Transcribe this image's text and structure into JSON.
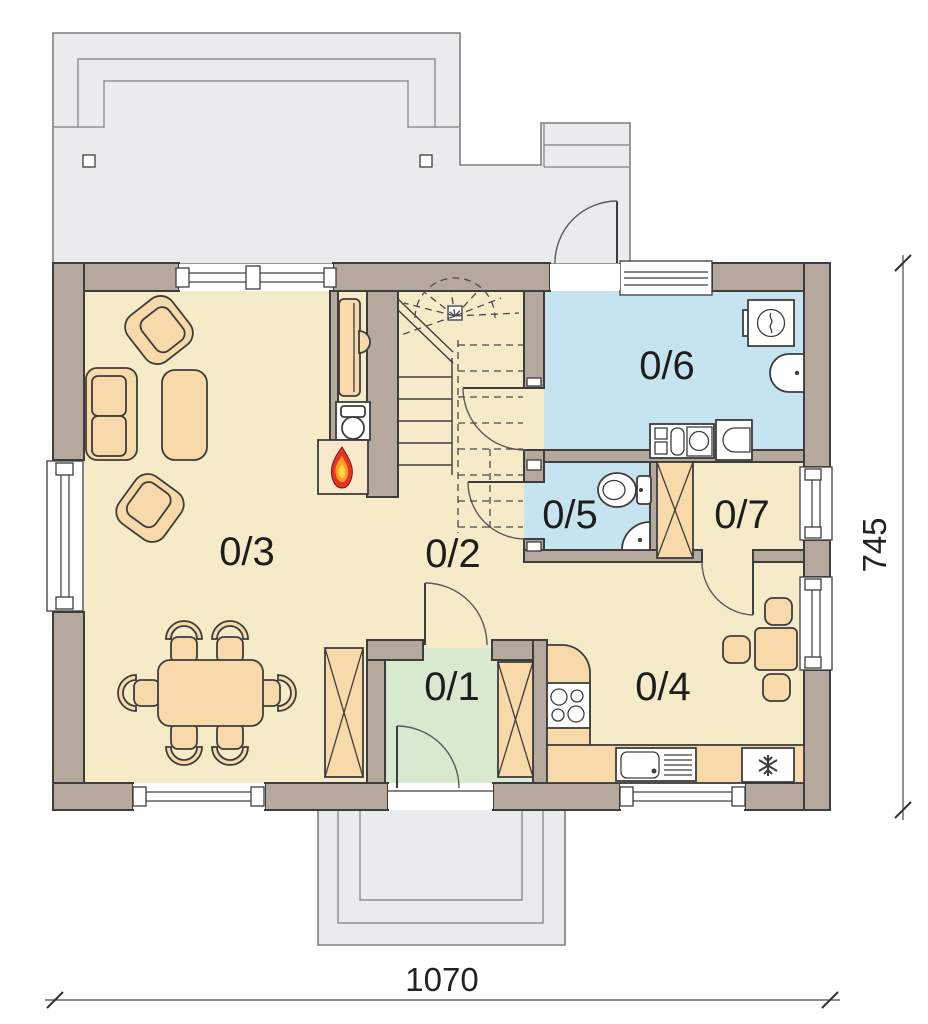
{
  "plan": {
    "type": "house-ground-floor-plan",
    "rooms": {
      "r1": {
        "label": "0/1",
        "name": "entrance-hall",
        "floor_color": "#d8e9d0"
      },
      "r2": {
        "label": "0/2",
        "name": "hall-corridor",
        "floor_color": "#f6ebc8"
      },
      "r3": {
        "label": "0/3",
        "name": "living-room",
        "floor_color": "#f6ebc8"
      },
      "r4": {
        "label": "0/4",
        "name": "kitchen",
        "floor_color": "#f6ebc8"
      },
      "r5": {
        "label": "0/5",
        "name": "wc",
        "floor_color": "#c6e4f0"
      },
      "r6": {
        "label": "0/6",
        "name": "bathroom-laundry",
        "floor_color": "#c6e4f0"
      },
      "r7": {
        "label": "0/7",
        "name": "pantry-closet",
        "floor_color": "#f6ebc8"
      }
    },
    "dimensions": {
      "width_label": "1070",
      "height_label": "745"
    },
    "colors": {
      "wall": "#b5a89c",
      "terrace": "#e9ebec",
      "furniture": "#f8d9a9",
      "flame_red": "#e5332a",
      "flame_orange": "#ff9d1f",
      "flame_yellow": "#ffd94f",
      "outline": "#3d3d3d"
    },
    "fixtures": [
      "stairs",
      "fireplace",
      "wood-stove",
      "tv-cabinet",
      "sofa",
      "armchair",
      "coffee-table",
      "dining-table",
      "dining-chair",
      "wardrobe",
      "kitchen-counter",
      "cooktop",
      "kitchen-sink",
      "fridge-freezer",
      "kitchen-table",
      "washing-machine",
      "washbasin",
      "toilet",
      "bidet",
      "corner-sink",
      "terrace",
      "entrance-porch"
    ]
  }
}
